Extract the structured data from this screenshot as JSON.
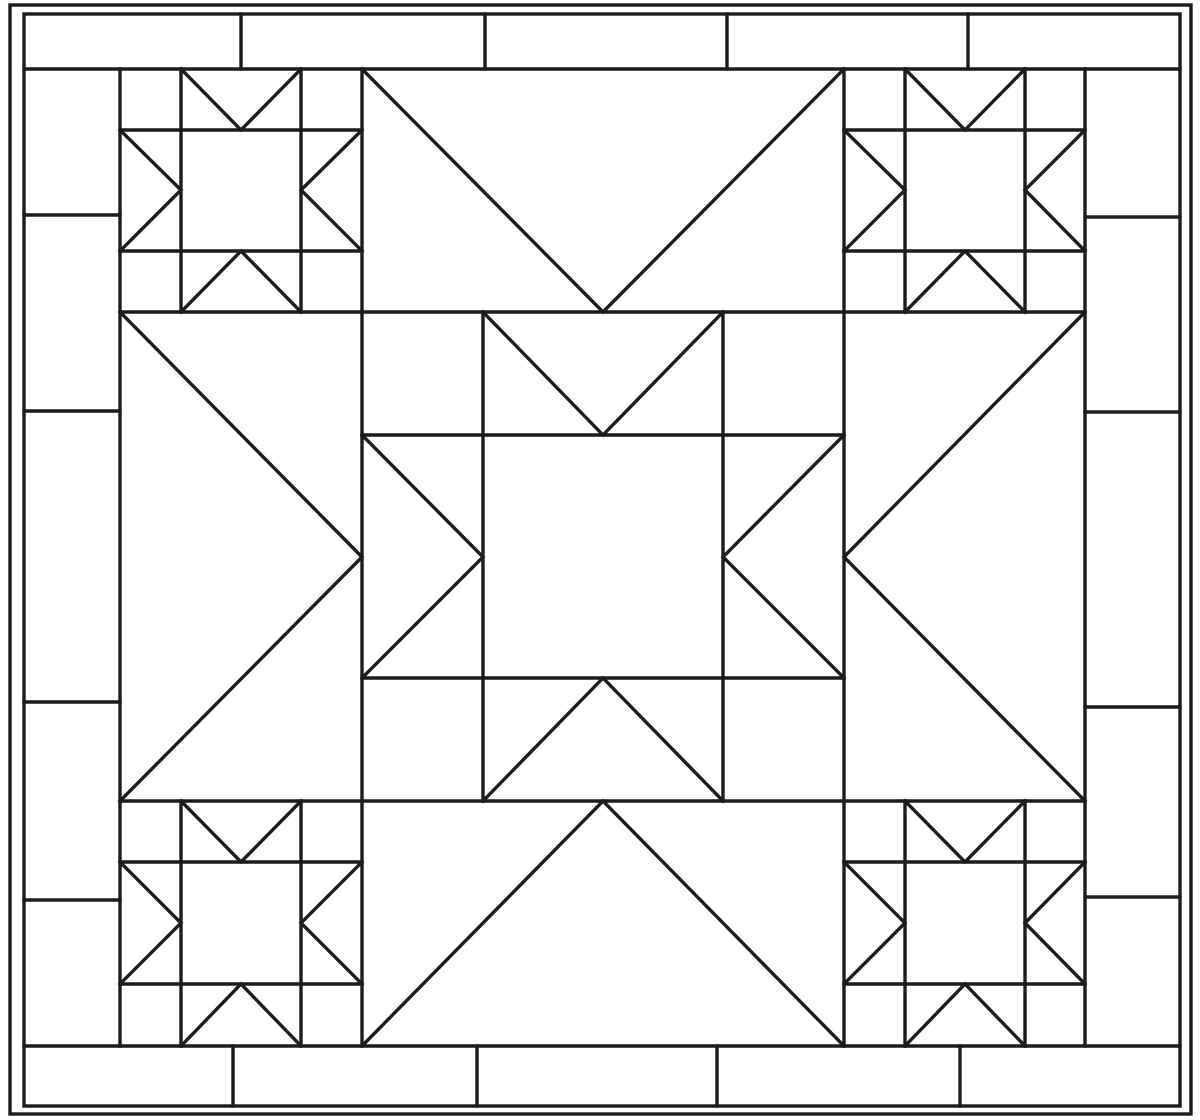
{
  "canvas": {
    "width": 1200,
    "height": 1120,
    "background_color": "#ffffff",
    "stroke_color": "#1c1c1c",
    "stroke_width": 3.4
  },
  "drawing": {
    "groups": [
      {
        "name": "outer-border-frame",
        "shapes": [
          {
            "name": "outer-frame-line",
            "type": "rect",
            "x": 10,
            "y": 5,
            "w": 1181,
            "h": 1109
          },
          {
            "name": "inner-frame-line",
            "type": "rect",
            "x": 24,
            "y": 14,
            "w": 1156,
            "h": 1092
          }
        ]
      },
      {
        "name": "brick-border",
        "shapes": [
          {
            "name": "top-band-bottom-edge",
            "type": "line",
            "x1": 24,
            "y1": 69,
            "x2": 1180,
            "y2": 69
          },
          {
            "name": "bottom-band-top-edge",
            "type": "line",
            "x1": 24,
            "y1": 1046,
            "x2": 1180,
            "y2": 1046
          },
          {
            "name": "left-band-right-edge",
            "type": "line",
            "x1": 120,
            "y1": 69,
            "x2": 120,
            "y2": 1046
          },
          {
            "name": "right-band-left-edge",
            "type": "line",
            "x1": 1085,
            "y1": 69,
            "x2": 1085,
            "y2": 1046
          },
          {
            "name": "top-band-seam-1",
            "type": "line",
            "x1": 241,
            "y1": 14,
            "x2": 241,
            "y2": 69
          },
          {
            "name": "top-band-seam-2",
            "type": "line",
            "x1": 485,
            "y1": 14,
            "x2": 485,
            "y2": 69
          },
          {
            "name": "top-band-seam-3",
            "type": "line",
            "x1": 727,
            "y1": 14,
            "x2": 727,
            "y2": 69
          },
          {
            "name": "top-band-seam-4",
            "type": "line",
            "x1": 968,
            "y1": 14,
            "x2": 968,
            "y2": 69
          },
          {
            "name": "bottom-band-seam-1",
            "type": "line",
            "x1": 233,
            "y1": 1046,
            "x2": 233,
            "y2": 1106
          },
          {
            "name": "bottom-band-seam-2",
            "type": "line",
            "x1": 477,
            "y1": 1046,
            "x2": 477,
            "y2": 1106
          },
          {
            "name": "bottom-band-seam-3",
            "type": "line",
            "x1": 717,
            "y1": 1046,
            "x2": 717,
            "y2": 1106
          },
          {
            "name": "bottom-band-seam-4",
            "type": "line",
            "x1": 960,
            "y1": 1046,
            "x2": 960,
            "y2": 1106
          },
          {
            "name": "left-band-seam-1",
            "type": "line",
            "x1": 24,
            "y1": 215,
            "x2": 120,
            "y2": 215
          },
          {
            "name": "left-band-seam-2",
            "type": "line",
            "x1": 24,
            "y1": 411,
            "x2": 120,
            "y2": 411
          },
          {
            "name": "left-band-seam-3",
            "type": "line",
            "x1": 24,
            "y1": 702,
            "x2": 120,
            "y2": 702
          },
          {
            "name": "left-band-seam-4",
            "type": "line",
            "x1": 24,
            "y1": 900,
            "x2": 120,
            "y2": 900
          },
          {
            "name": "right-band-seam-1",
            "type": "line",
            "x1": 1085,
            "y1": 217,
            "x2": 1180,
            "y2": 217
          },
          {
            "name": "right-band-seam-2",
            "type": "line",
            "x1": 1085,
            "y1": 412,
            "x2": 1180,
            "y2": 412
          },
          {
            "name": "right-band-seam-3",
            "type": "line",
            "x1": 1085,
            "y1": 707,
            "x2": 1180,
            "y2": 707
          },
          {
            "name": "right-band-seam-4",
            "type": "line",
            "x1": 1085,
            "y1": 897,
            "x2": 1180,
            "y2": 897
          }
        ]
      },
      {
        "name": "quilt-sashing-grid",
        "shapes": [
          {
            "name": "column-seam-left",
            "type": "line",
            "x1": 362,
            "y1": 69,
            "x2": 362,
            "y2": 1046
          },
          {
            "name": "column-seam-right",
            "type": "line",
            "x1": 844,
            "y1": 69,
            "x2": 844,
            "y2": 1046
          },
          {
            "name": "row-seam-top",
            "type": "line",
            "x1": 120,
            "y1": 312,
            "x2": 1085,
            "y2": 312
          },
          {
            "name": "row-seam-bottom",
            "type": "line",
            "x1": 120,
            "y1": 801,
            "x2": 1085,
            "y2": 801
          }
        ]
      },
      {
        "name": "star-block-top-left",
        "shapes": [
          {
            "name": "grid-line-left",
            "type": "line",
            "x1": 181,
            "y1": 69,
            "x2": 181,
            "y2": 312
          },
          {
            "name": "grid-line-right",
            "type": "line",
            "x1": 301,
            "y1": 69,
            "x2": 301,
            "y2": 312
          },
          {
            "name": "grid-line-top",
            "type": "line",
            "x1": 120,
            "y1": 130,
            "x2": 362,
            "y2": 130
          },
          {
            "name": "grid-line-bottom",
            "type": "line",
            "x1": 120,
            "y1": 251,
            "x2": 362,
            "y2": 251
          },
          {
            "name": "goose-north",
            "type": "polyline",
            "points": [
              [
                181,
                69
              ],
              [
                241,
                130
              ],
              [
                301,
                69
              ]
            ]
          },
          {
            "name": "goose-west",
            "type": "polyline",
            "points": [
              [
                120,
                130
              ],
              [
                181,
                190
              ],
              [
                120,
                251
              ]
            ]
          },
          {
            "name": "goose-east",
            "type": "polyline",
            "points": [
              [
                362,
                130
              ],
              [
                301,
                190
              ],
              [
                362,
                251
              ]
            ]
          },
          {
            "name": "goose-south",
            "type": "polyline",
            "points": [
              [
                181,
                312
              ],
              [
                241,
                251
              ],
              [
                301,
                312
              ]
            ]
          }
        ]
      },
      {
        "name": "star-block-top-right",
        "shapes": [
          {
            "name": "grid-line-left",
            "type": "line",
            "x1": 905,
            "y1": 69,
            "x2": 905,
            "y2": 312
          },
          {
            "name": "grid-line-right",
            "type": "line",
            "x1": 1025,
            "y1": 69,
            "x2": 1025,
            "y2": 312
          },
          {
            "name": "grid-line-top",
            "type": "line",
            "x1": 844,
            "y1": 130,
            "x2": 1085,
            "y2": 130
          },
          {
            "name": "grid-line-bottom",
            "type": "line",
            "x1": 844,
            "y1": 251,
            "x2": 1085,
            "y2": 251
          },
          {
            "name": "goose-north",
            "type": "polyline",
            "points": [
              [
                905,
                69
              ],
              [
                965,
                130
              ],
              [
                1025,
                69
              ]
            ]
          },
          {
            "name": "goose-west",
            "type": "polyline",
            "points": [
              [
                844,
                130
              ],
              [
                905,
                190
              ],
              [
                844,
                251
              ]
            ]
          },
          {
            "name": "goose-east",
            "type": "polyline",
            "points": [
              [
                1085,
                130
              ],
              [
                1025,
                190
              ],
              [
                1085,
                251
              ]
            ]
          },
          {
            "name": "goose-south",
            "type": "polyline",
            "points": [
              [
                905,
                312
              ],
              [
                965,
                251
              ],
              [
                1025,
                312
              ]
            ]
          }
        ]
      },
      {
        "name": "star-block-bottom-left",
        "shapes": [
          {
            "name": "grid-line-left",
            "type": "line",
            "x1": 181,
            "y1": 801,
            "x2": 181,
            "y2": 1046
          },
          {
            "name": "grid-line-right",
            "type": "line",
            "x1": 301,
            "y1": 801,
            "x2": 301,
            "y2": 1046
          },
          {
            "name": "grid-line-top",
            "type": "line",
            "x1": 120,
            "y1": 862,
            "x2": 362,
            "y2": 862
          },
          {
            "name": "grid-line-bottom",
            "type": "line",
            "x1": 120,
            "y1": 984,
            "x2": 362,
            "y2": 984
          },
          {
            "name": "goose-north",
            "type": "polyline",
            "points": [
              [
                181,
                801
              ],
              [
                241,
                862
              ],
              [
                301,
                801
              ]
            ]
          },
          {
            "name": "goose-west",
            "type": "polyline",
            "points": [
              [
                120,
                862
              ],
              [
                181,
                923
              ],
              [
                120,
                984
              ]
            ]
          },
          {
            "name": "goose-east",
            "type": "polyline",
            "points": [
              [
                362,
                862
              ],
              [
                301,
                923
              ],
              [
                362,
                984
              ]
            ]
          },
          {
            "name": "goose-south",
            "type": "polyline",
            "points": [
              [
                181,
                1046
              ],
              [
                241,
                984
              ],
              [
                301,
                1046
              ]
            ]
          }
        ]
      },
      {
        "name": "star-block-bottom-right",
        "shapes": [
          {
            "name": "grid-line-left",
            "type": "line",
            "x1": 905,
            "y1": 801,
            "x2": 905,
            "y2": 1046
          },
          {
            "name": "grid-line-right",
            "type": "line",
            "x1": 1025,
            "y1": 801,
            "x2": 1025,
            "y2": 1046
          },
          {
            "name": "grid-line-top",
            "type": "line",
            "x1": 844,
            "y1": 862,
            "x2": 1085,
            "y2": 862
          },
          {
            "name": "grid-line-bottom",
            "type": "line",
            "x1": 844,
            "y1": 984,
            "x2": 1085,
            "y2": 984
          },
          {
            "name": "goose-north",
            "type": "polyline",
            "points": [
              [
                905,
                801
              ],
              [
                965,
                862
              ],
              [
                1025,
                801
              ]
            ]
          },
          {
            "name": "goose-west",
            "type": "polyline",
            "points": [
              [
                844,
                862
              ],
              [
                905,
                923
              ],
              [
                844,
                984
              ]
            ]
          },
          {
            "name": "goose-east",
            "type": "polyline",
            "points": [
              [
                1085,
                862
              ],
              [
                1025,
                923
              ],
              [
                1085,
                984
              ]
            ]
          },
          {
            "name": "goose-south",
            "type": "polyline",
            "points": [
              [
                905,
                1046
              ],
              [
                965,
                984
              ],
              [
                1025,
                1046
              ]
            ]
          }
        ]
      },
      {
        "name": "star-block-center",
        "shapes": [
          {
            "name": "grid-line-left",
            "type": "line",
            "x1": 483,
            "y1": 312,
            "x2": 483,
            "y2": 801
          },
          {
            "name": "grid-line-right",
            "type": "line",
            "x1": 723,
            "y1": 312,
            "x2": 723,
            "y2": 801
          },
          {
            "name": "grid-line-top",
            "type": "line",
            "x1": 362,
            "y1": 435,
            "x2": 844,
            "y2": 435
          },
          {
            "name": "grid-line-bottom",
            "type": "line",
            "x1": 362,
            "y1": 678,
            "x2": 844,
            "y2": 678
          },
          {
            "name": "goose-north",
            "type": "polyline",
            "points": [
              [
                483,
                312
              ],
              [
                603,
                435
              ],
              [
                723,
                312
              ]
            ]
          },
          {
            "name": "goose-west",
            "type": "polyline",
            "points": [
              [
                362,
                435
              ],
              [
                483,
                557
              ],
              [
                362,
                678
              ]
            ]
          },
          {
            "name": "goose-east",
            "type": "polyline",
            "points": [
              [
                844,
                435
              ],
              [
                723,
                557
              ],
              [
                844,
                678
              ]
            ]
          },
          {
            "name": "goose-south",
            "type": "polyline",
            "points": [
              [
                483,
                801
              ],
              [
                603,
                678
              ],
              [
                723,
                801
              ]
            ]
          }
        ]
      },
      {
        "name": "setting-triangles",
        "shapes": [
          {
            "name": "setting-triangle-top",
            "type": "polyline",
            "points": [
              [
                362,
                69
              ],
              [
                603,
                312
              ],
              [
                844,
                69
              ]
            ]
          },
          {
            "name": "setting-triangle-left",
            "type": "polyline",
            "points": [
              [
                120,
                312
              ],
              [
                362,
                557
              ],
              [
                120,
                801
              ]
            ]
          },
          {
            "name": "setting-triangle-right",
            "type": "polyline",
            "points": [
              [
                1085,
                312
              ],
              [
                844,
                557
              ],
              [
                1085,
                801
              ]
            ]
          },
          {
            "name": "setting-triangle-bottom",
            "type": "polyline",
            "points": [
              [
                362,
                1046
              ],
              [
                603,
                801
              ],
              [
                844,
                1046
              ]
            ]
          }
        ]
      }
    ]
  }
}
